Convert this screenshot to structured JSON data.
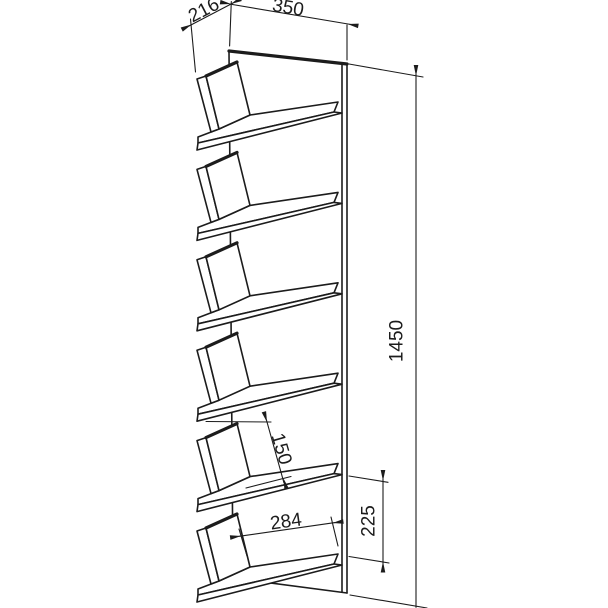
{
  "drawing": {
    "type": "technical-drawing",
    "subject": "wall shelf with six angled boards",
    "background": "#ffffff",
    "line_color": "#1c1c1c",
    "shelf_count": 6
  },
  "dimensions": {
    "top_depth": {
      "value": "216"
    },
    "top_width": {
      "value": "350"
    },
    "height": {
      "value": "1450"
    },
    "board_height": {
      "value": "150"
    },
    "shelf_gap": {
      "value": "225"
    },
    "shelf_clear_width": {
      "value": "284"
    }
  }
}
